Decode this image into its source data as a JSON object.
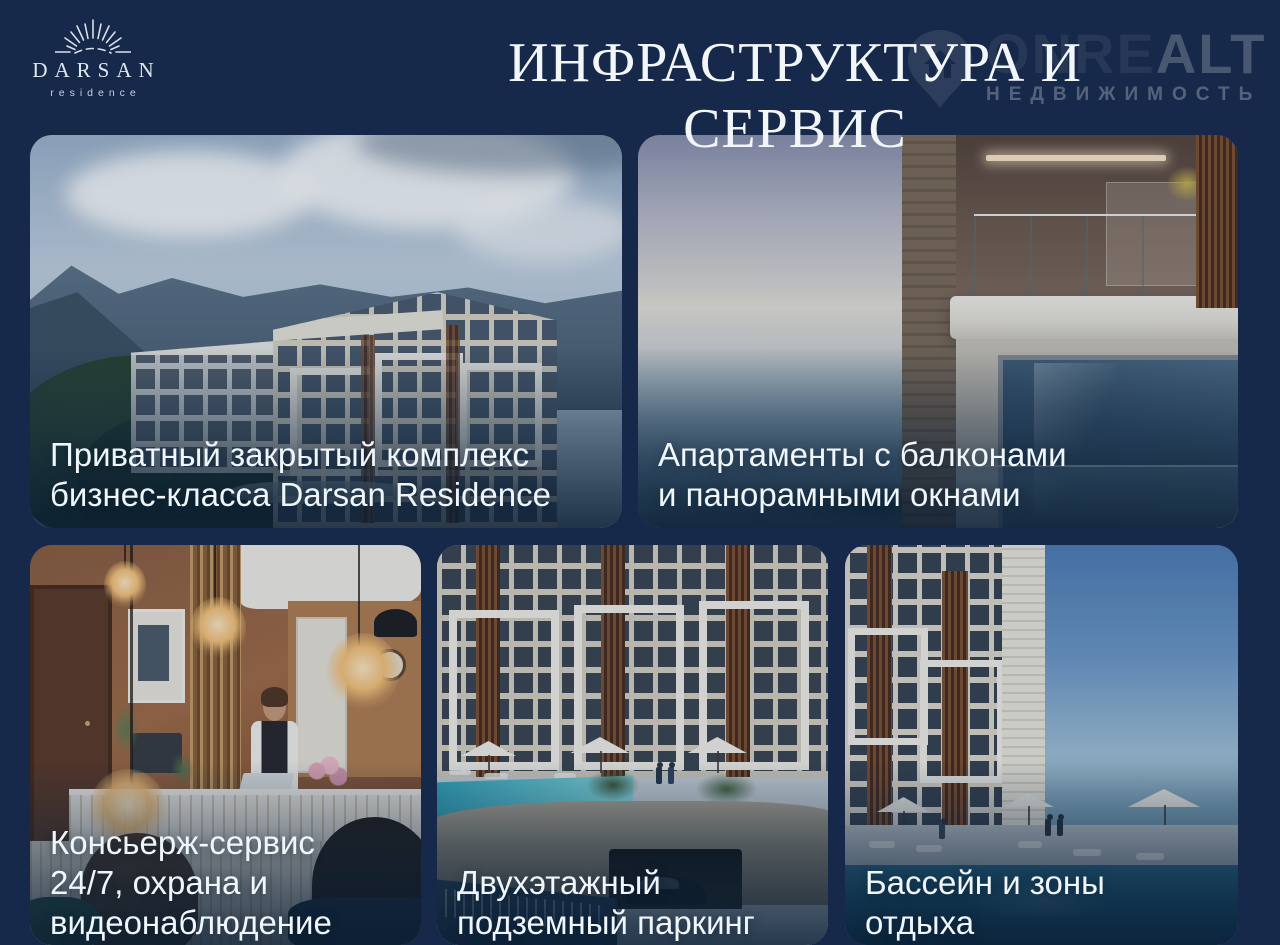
{
  "colors": {
    "background": "#16294a",
    "title_text": "#f3f6f8",
    "caption_text": "#eff5f9"
  },
  "logo": {
    "name": "DARSAN",
    "subtitle": "residence"
  },
  "header": {
    "title": "ИНФРАСТРУКТУРА И СЕРВИС"
  },
  "watermark": {
    "brand_left": "ONRE",
    "brand_right": "ALT",
    "subtitle": "НЕДВИЖИМОСТЬ"
  },
  "cards": [
    {
      "caption": "Приватный закрытый комплекс\nбизнес-класса Darsan Residence"
    },
    {
      "caption": "Апартаменты с балконами\nи панорамными окнами"
    },
    {
      "caption": "Консьерж-сервис\n24/7, охрана и\nвидеонаблюдение"
    },
    {
      "caption": "Двухэтажный\nподземный паркинг"
    },
    {
      "caption": "Бассейн и зоны\nотдыха"
    }
  ]
}
